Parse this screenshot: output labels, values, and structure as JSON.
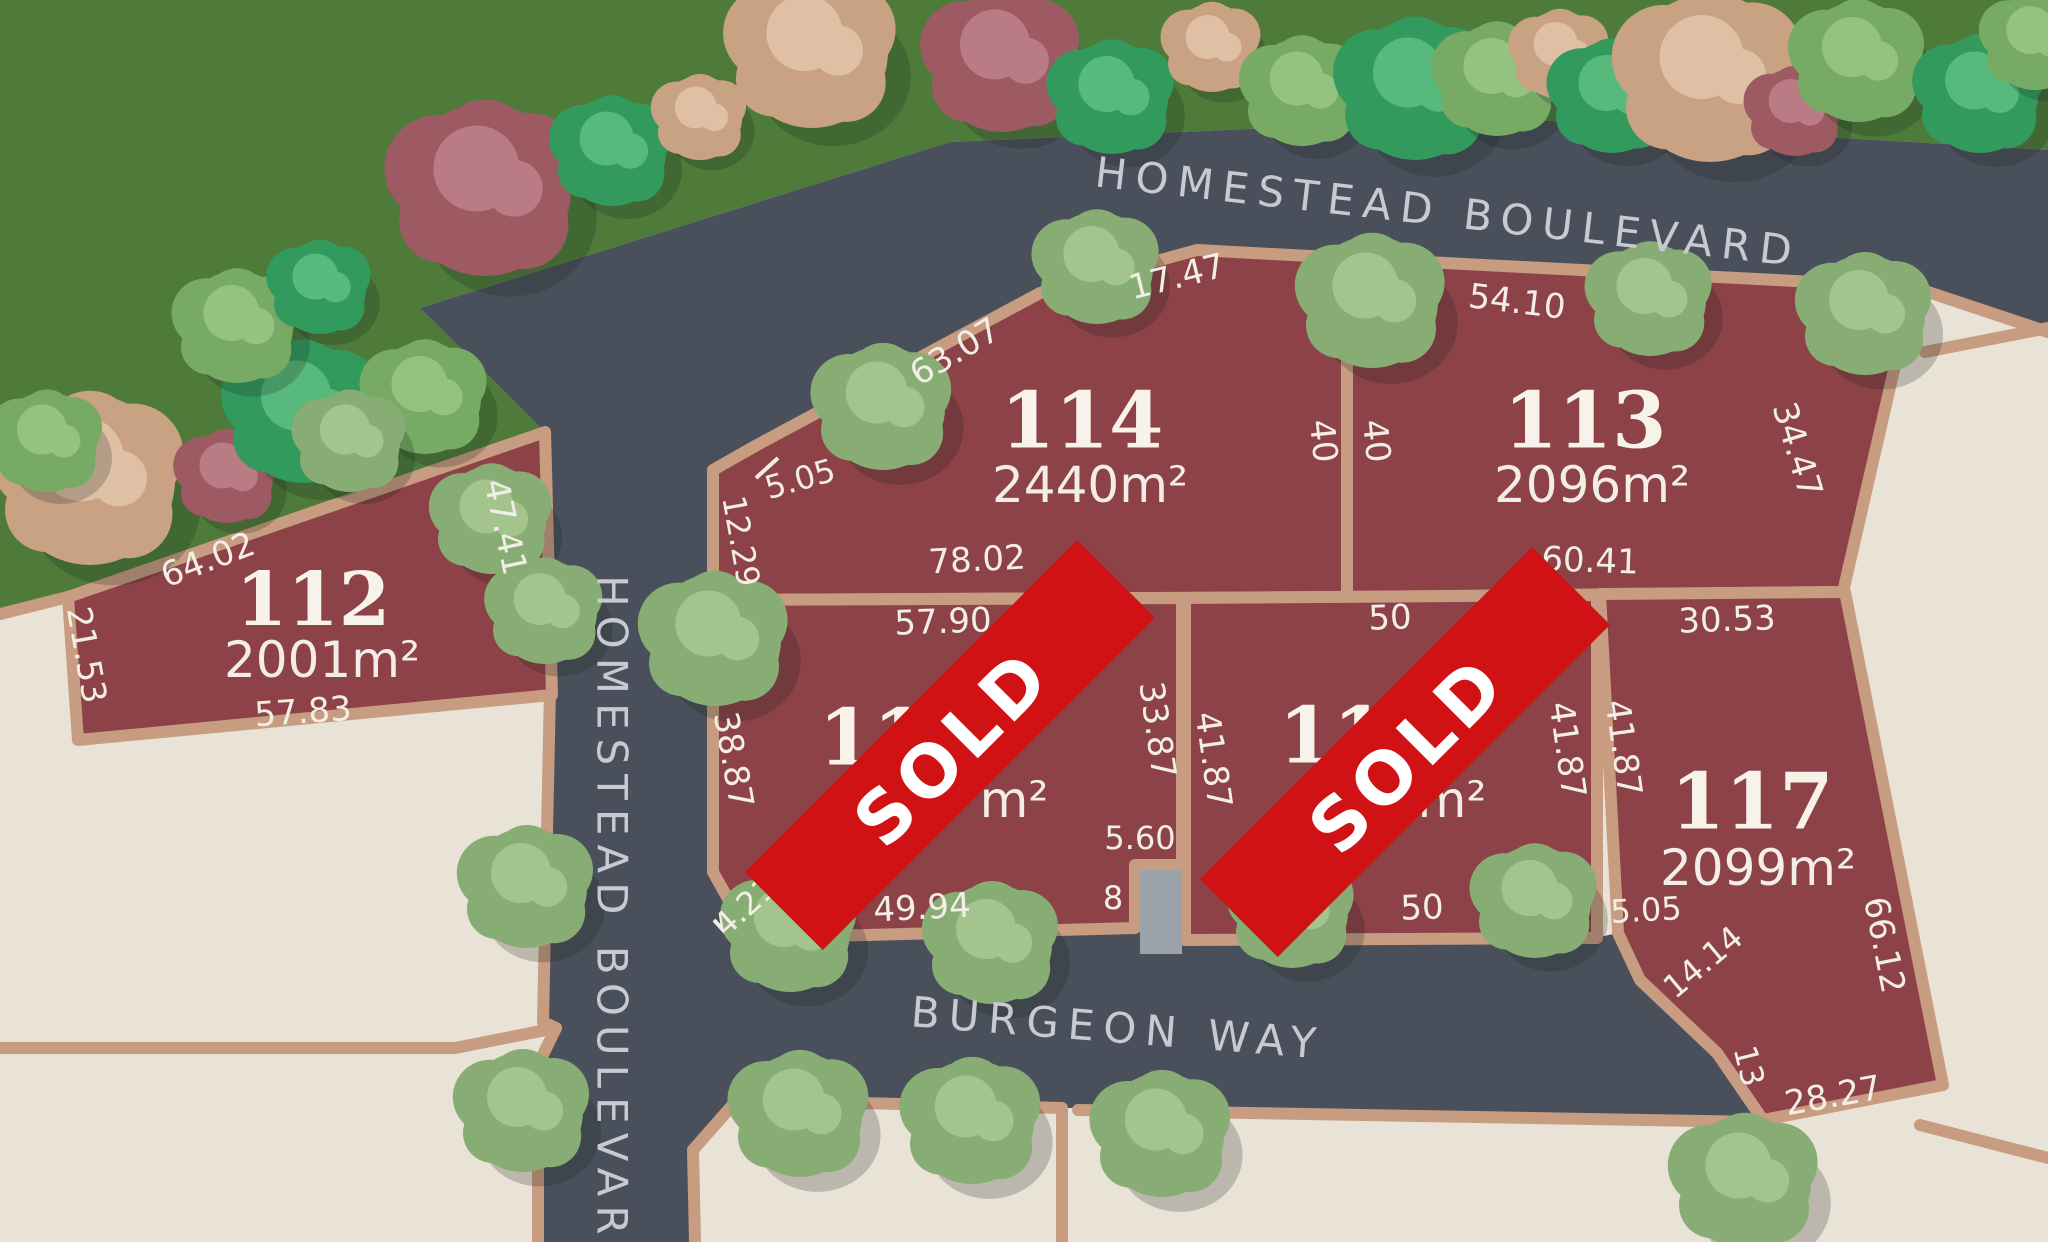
{
  "streets": {
    "homestead_diagonal": "HOMESTEAD BOULEVARD",
    "homestead_vertical": "HOMESTEAD BOULEVARD",
    "burgeon": "BURGEON WAY"
  },
  "sold_label": "SOLD",
  "lots": [
    {
      "number": "112",
      "area": "2001m²",
      "sold": false,
      "dimensions": [
        "64.02",
        "21.53",
        "57.83",
        "47.41"
      ]
    },
    {
      "number": "114",
      "area": "2440m²",
      "sold": false,
      "dimensions": [
        "63.07",
        "17.47",
        "5.05",
        "12.29",
        "78.02",
        "40"
      ]
    },
    {
      "number": "113",
      "area": "2096m²",
      "sold": false,
      "dimensions": [
        "54.10",
        "40",
        "60.41",
        "34.47"
      ]
    },
    {
      "number": "115",
      "area_visible": "m²",
      "sold": true,
      "dimensions": [
        "57.90",
        "38.87",
        "4.21",
        "49.94",
        "33.87",
        "5.60",
        "8"
      ]
    },
    {
      "number": "116",
      "area_visible": "m²",
      "sold": true,
      "dimensions": [
        "50",
        "41.87",
        "50",
        "41.87"
      ]
    },
    {
      "number": "117",
      "area": "2099m²",
      "sold": false,
      "dimensions": [
        "30.53",
        "41.87",
        "5.05",
        "14.14",
        "13",
        "28.27",
        "66.12"
      ]
    }
  ],
  "colors": {
    "grass": "#4e7b3a",
    "road": "#49505b",
    "lot_fill": "#8c4247",
    "lot_border": "#c79c80",
    "beige": "#e9e2d7",
    "driveway": "#9ca2aa",
    "sold_banner": "#d01215",
    "dimension_text": "#f2eee7",
    "street_text": "#c7cad0",
    "tree_sage": [
      "#88ad74",
      "#a4c48e"
    ],
    "tree_green": [
      "#339a5d",
      "#58b97c"
    ],
    "tree_green_light": [
      "#77ab65",
      "#93c281"
    ],
    "tree_tan": [
      "#c9a284",
      "#e0c0a4"
    ],
    "tree_maroon": [
      "#9d5a63",
      "#b97b84"
    ]
  }
}
